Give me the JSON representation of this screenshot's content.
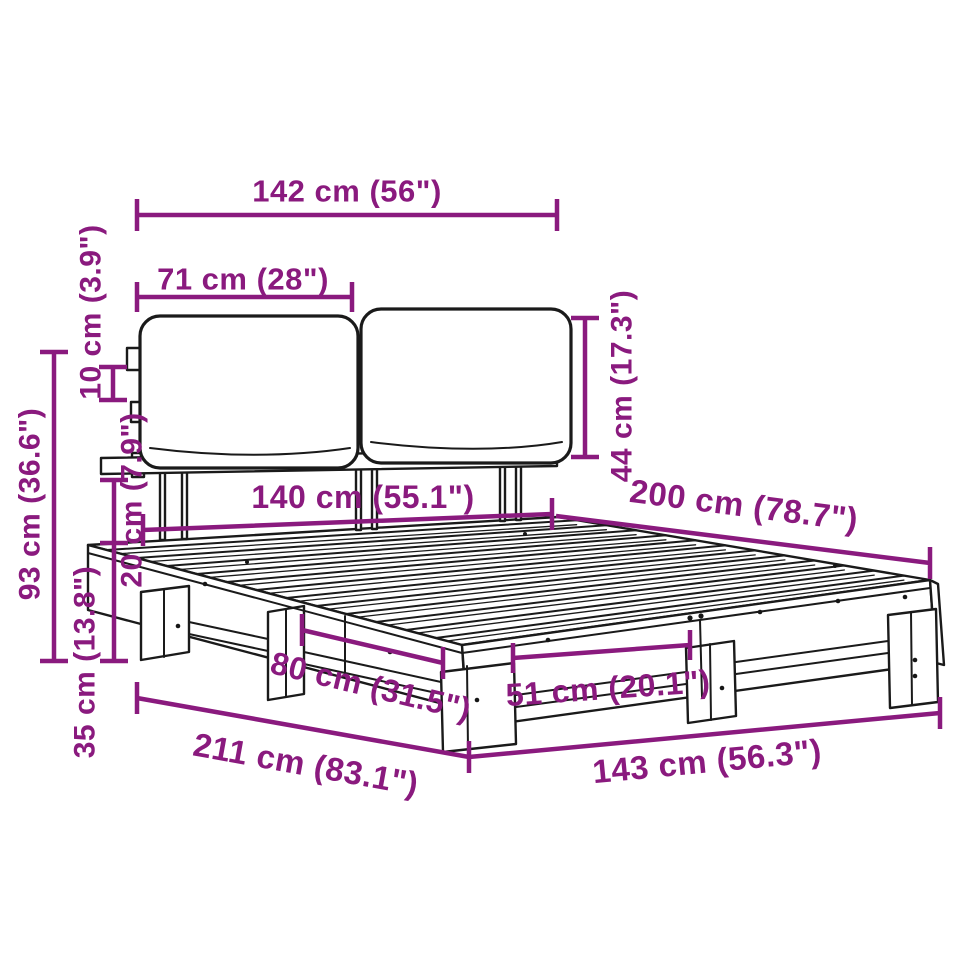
{
  "diagram": {
    "title": "bed-frame-dimension-diagram",
    "accent_color": "#8A1A7E",
    "line_color": "#1a1a1a",
    "background": "#ffffff",
    "units": [
      "cm",
      "in"
    ],
    "dimensions": [
      {
        "id": "headboard-width",
        "label": "142 cm (56\")"
      },
      {
        "id": "cushion-width",
        "label": "71 cm (28\")"
      },
      {
        "id": "bracket-gap",
        "label": "10 cm (3.9\")"
      },
      {
        "id": "headboard-height",
        "label": "93 cm (36.6\")"
      },
      {
        "id": "frame-height",
        "label": "20 cm (7.9\")"
      },
      {
        "id": "leg-height",
        "label": "35 cm (13.8\")"
      },
      {
        "id": "cushion-height",
        "label": "44 cm (17.3\")"
      },
      {
        "id": "mattress-width",
        "label": "140 cm (55.1\")"
      },
      {
        "id": "bed-length",
        "label": "200 cm (78.7\")"
      },
      {
        "id": "side-leg-spacing",
        "label": "80 cm (31.5\")"
      },
      {
        "id": "foot-leg-spacing",
        "label": "51 cm (20.1\")"
      },
      {
        "id": "overall-length",
        "label": "211 cm (83.1\")"
      },
      {
        "id": "overall-width",
        "label": "143 cm (56.3\")"
      }
    ]
  }
}
